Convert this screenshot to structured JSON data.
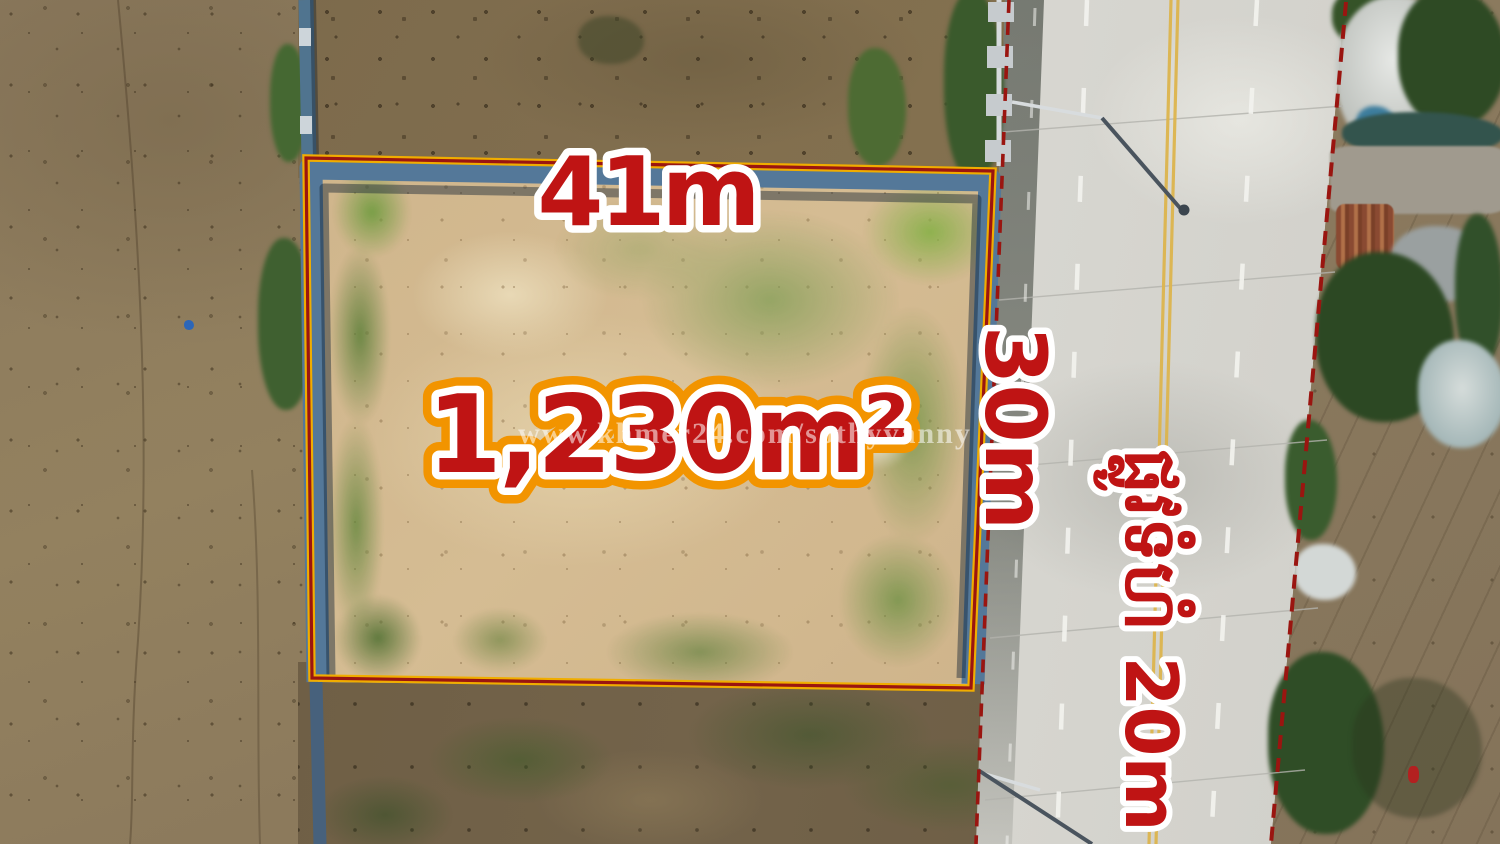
{
  "photo": {
    "annotations": {
      "top_length_label": "41m",
      "right_depth_label": "30m",
      "area_label": "1,230m²",
      "road_width_label": "ផ្លូវទំហំ 20m",
      "watermark": "www.khmer24.com/sothyvanny"
    },
    "colors": {
      "annotation_red": "#bf1414",
      "annotation_outline_white": "#ffffff",
      "area_outline_orange": "#f29400",
      "boundary_yellow": "#f0ad00",
      "boundary_red": "#9a1510",
      "road_edge_dash_red": "#9a1510",
      "road_centerline_yellow": "#ddb54e",
      "watermark_white": "rgba(255,255,255,0.55)"
    },
    "scene": {
      "description": "Aerial drone photo of a fenced vacant land plot between a flooded field and a concrete road",
      "plot_area": "1,230m²",
      "plot_frontage": "41m",
      "plot_depth": "30m",
      "road_width": "20m"
    }
  }
}
